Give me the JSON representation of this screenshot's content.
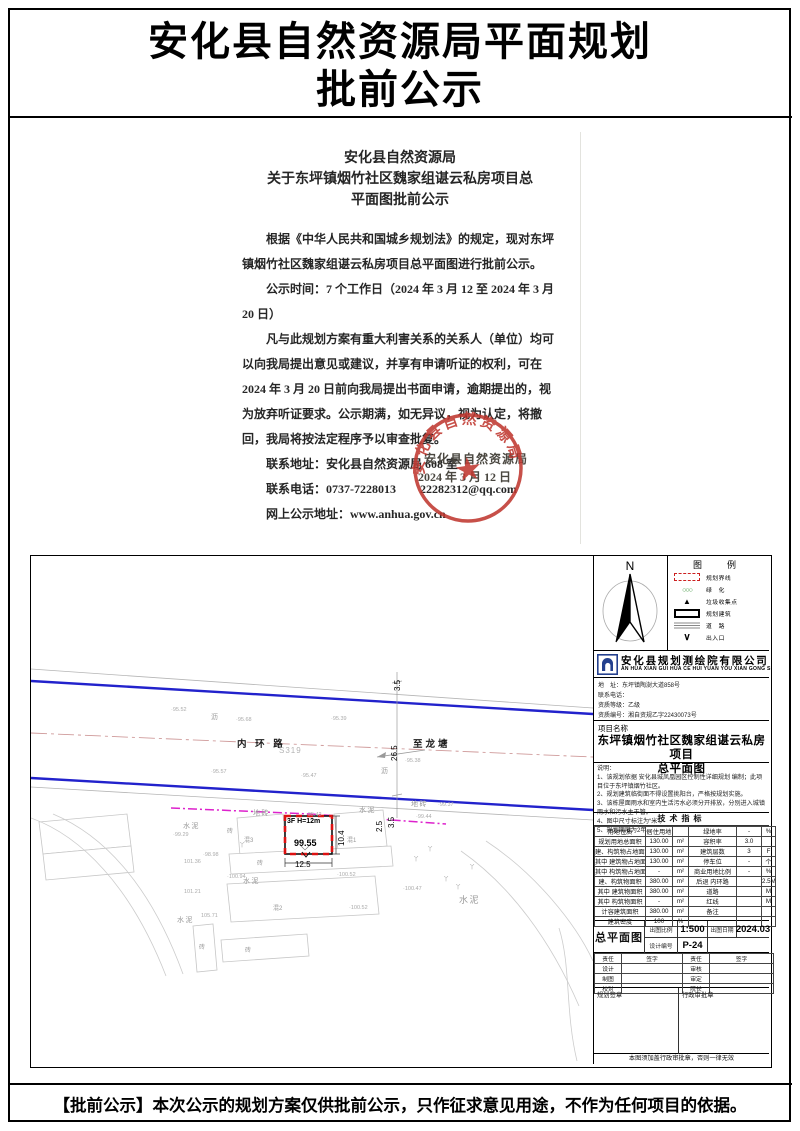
{
  "page": {
    "title_line1": "安化县自然资源局平面规划",
    "title_line2": "批前公示",
    "footer_notice": "【批前公示】本次公示的规划方案仅供批前公示，只作征求意见用途，不作为任何项目的依据。"
  },
  "letter": {
    "heading_lines": [
      "安化县自然资源局",
      "关于东坪镇烟竹社区魏家组谌云私房项目总",
      "平面图批前公示"
    ],
    "paragraphs": [
      "根据《中华人民共和国城乡规划法》的规定，现对东坪镇烟竹社区魏家组谌云私房项目总平面图进行批前公示。",
      "公示时间：7 个工作日（2024 年 3 月 12 至 2024 年 3 月 20 日）",
      "凡与此规划方案有重大利害关系的关系人（单位）均可以向我局提出意见或建议，并享有申请听证的权利，可在 2024 年 3 月 20 日前向我局提出书面申请，逾期提出的，视为放弃听证要求。公示期满，如无异议，视为认定，将撤回，我局将按法定程序予以审查批复。",
      "联系地址：安化县自然资源局 608 室",
      "联系电话：0737-7228013　　22282312@qq.com",
      "网上公示地址：www.anhua.gov.cn"
    ],
    "signature_org": "安化县自然资源局",
    "signature_date": "2024 年 3 月 12 日",
    "stamp_text": "安化县自然资源局"
  },
  "drawing": {
    "compass_label": "N",
    "legend": {
      "title": "图　例",
      "items": [
        {
          "sym": "boundary",
          "label": "规划界线"
        },
        {
          "sym": "green",
          "label": "绿　化"
        },
        {
          "sym": "trash",
          "label": "垃圾收集点"
        },
        {
          "sym": "building",
          "label": "规划建筑"
        },
        {
          "sym": "road",
          "label": "道　路"
        },
        {
          "sym": "entrance",
          "label": "出入口"
        }
      ]
    },
    "company": {
      "name": "安化县规划测绘院有限公司",
      "pinyin": "AN HUA XIAN GUI HUA CE HUI YUAN YOU XIAN GONG SI",
      "address_label": "地　址：东坪镇陶澍大道858号",
      "phone_label": "联系电话：",
      "grade_label": "资质等级：乙级",
      "cert_label": "资质编号：湘自资规乙字22430073号"
    },
    "project": {
      "label": "项目名称",
      "name_line1": "东坪镇烟竹社区魏家组谌云私房项目",
      "name_line2": "总平面图"
    },
    "notes": {
      "title": "说明：",
      "items": [
        "1、该规划依据 安化县城凤凰园区控制性详细规划 编制；此项目位于东坪镇烟竹社区。",
        "2、规划建筑临街面不得设置挑阳台，严格按规划实施。",
        "3、该栋屋面雨水和室内生活污水必须分开排放，分别进入城镇雨水和污水主干管。",
        "4、图中尺寸标注为“米”。",
        "5、规划期限为2年。"
      ]
    },
    "tech": {
      "title": "技术指标",
      "rows": [
        [
          "用地性质",
          "居住用地",
          "",
          "绿地率",
          "-",
          "%"
        ],
        [
          "规划用地总面积",
          "130.00",
          "m²",
          "容积率",
          "3.0",
          ""
        ],
        [
          "建、构筑物占地面积",
          "130.00",
          "m²",
          "建筑层数",
          "3",
          "F"
        ],
        [
          "其中 建筑物占地面积",
          "130.00",
          "m²",
          "停车位",
          "-",
          "个"
        ],
        [
          "其中 构筑物占地面积",
          "-",
          "m²",
          "商业用地比例",
          "-",
          "%"
        ],
        [
          "建、构筑物面积",
          "380.00",
          "m²",
          "后退 内环路",
          "",
          "2.5M"
        ],
        [
          "其中 建筑物面积",
          "380.00",
          "m²",
          "道路",
          "",
          "M"
        ],
        [
          "其中 构筑物面积",
          "-",
          "m²",
          "红线",
          "",
          "M"
        ],
        [
          "计容建筑面积",
          "380.00",
          "m²",
          "备注",
          "",
          ""
        ],
        [
          "建筑密度",
          "100",
          "%",
          "",
          "",
          ""
        ]
      ]
    },
    "sheet": {
      "name": "总平面图",
      "scale_label": "出图比例",
      "scale": "1:500",
      "date_label": "出图日期",
      "date": "2024.03",
      "no_label": "设计编号",
      "no": "P-24"
    },
    "signoff": {
      "header": [
        "责任",
        "签字",
        "责任",
        "签字"
      ],
      "rows": [
        [
          "设计",
          "",
          "审核",
          ""
        ],
        [
          "制图",
          "",
          "审定",
          ""
        ],
        [
          "校对",
          "",
          "院长",
          ""
        ]
      ],
      "left_stamp_label": "规划签章",
      "right_stamp_label": "行政审批章",
      "footnote": "本图须加盖行政审批章，否则一律无效"
    },
    "map": {
      "labels": [
        {
          "t": "沥",
          "x": 180,
          "y": 156,
          "cls": "surf"
        },
        {
          "t": "·95.52",
          "x": 140,
          "y": 151,
          "cls": "elev"
        },
        {
          "t": "·95.68",
          "x": 205,
          "y": 161,
          "cls": "elev"
        },
        {
          "t": "·95.39",
          "x": 300,
          "y": 160,
          "cls": "elev"
        },
        {
          "t": "内 环 路",
          "x": 206,
          "y": 180,
          "cls": "road"
        },
        {
          "t": "S319",
          "x": 248,
          "y": 190,
          "cls": "s319"
        },
        {
          "t": "至龙塘",
          "x": 382,
          "y": 180,
          "cls": "road"
        },
        {
          "t": "·95.57",
          "x": 180,
          "y": 213,
          "cls": "elev"
        },
        {
          "t": "·95.47",
          "x": 270,
          "y": 217,
          "cls": "elev"
        },
        {
          "t": "·95.38",
          "x": 374,
          "y": 202,
          "cls": "elev"
        },
        {
          "t": "沥",
          "x": 350,
          "y": 210,
          "cls": "surf"
        },
        {
          "t": "26.5",
          "x": 359,
          "y": 205,
          "cls": "dim rot"
        },
        {
          "t": "3.5",
          "x": 362,
          "y": 135,
          "cls": "dim rot"
        },
        {
          "t": "地砖",
          "x": 222,
          "y": 252,
          "cls": "surf"
        },
        {
          "t": "·95.42",
          "x": 275,
          "y": 256,
          "cls": "elev"
        },
        {
          "t": "水泥",
          "x": 152,
          "y": 265,
          "cls": "surf"
        },
        {
          "t": "地砖",
          "x": 380,
          "y": 243,
          "cls": "surf"
        },
        {
          "t": "·99.37",
          "x": 407,
          "y": 246,
          "cls": "elev"
        },
        {
          "t": "水泥",
          "x": 328,
          "y": 249,
          "cls": "surf"
        },
        {
          "t": "·99.44",
          "x": 385,
          "y": 258,
          "cls": "elev"
        },
        {
          "t": "2.5",
          "x": 344,
          "y": 276,
          "cls": "dim rot"
        },
        {
          "t": "3.5",
          "x": 356,
          "y": 272,
          "cls": "dim rot"
        },
        {
          "t": "3F H=12m",
          "x": 256,
          "y": 262,
          "cls": "bldg-tag"
        },
        {
          "t": "99.55",
          "x": 263,
          "y": 282,
          "cls": "spot"
        },
        {
          "t": "10.4",
          "x": 306,
          "y": 290,
          "cls": "dim rot"
        },
        {
          "t": "12.5",
          "x": 264,
          "y": 304,
          "cls": "dim"
        },
        {
          "t": "砖",
          "x": 196,
          "y": 270,
          "cls": "bld"
        },
        {
          "t": "混3",
          "x": 213,
          "y": 279,
          "cls": "bld"
        },
        {
          "t": "混1",
          "x": 316,
          "y": 279,
          "cls": "bld"
        },
        {
          "t": "砖",
          "x": 226,
          "y": 302,
          "cls": "bld"
        },
        {
          "t": "·99.29",
          "x": 142,
          "y": 276,
          "cls": "elev"
        },
        {
          "t": "·98.98",
          "x": 172,
          "y": 296,
          "cls": "elev"
        },
        {
          "t": "101.36",
          "x": 153,
          "y": 303,
          "cls": "elev"
        },
        {
          "t": "·100.94",
          "x": 196,
          "y": 318,
          "cls": "elev"
        },
        {
          "t": "水泥",
          "x": 212,
          "y": 320,
          "cls": "surf"
        },
        {
          "t": "101.21",
          "x": 153,
          "y": 333,
          "cls": "elev"
        },
        {
          "t": "·100.52",
          "x": 306,
          "y": 316,
          "cls": "elev"
        },
        {
          "t": "水泥",
          "x": 146,
          "y": 359,
          "cls": "surf"
        },
        {
          "t": "105.71",
          "x": 170,
          "y": 357,
          "cls": "elev"
        },
        {
          "t": "混2",
          "x": 242,
          "y": 347,
          "cls": "bld"
        },
        {
          "t": "·100.47",
          "x": 372,
          "y": 330,
          "cls": "elev"
        },
        {
          "t": "水泥",
          "x": 428,
          "y": 337,
          "cls": "surf big"
        },
        {
          "t": "·100.52",
          "x": 318,
          "y": 349,
          "cls": "elev"
        },
        {
          "t": "砖",
          "x": 168,
          "y": 386,
          "cls": "bld"
        },
        {
          "t": "砖",
          "x": 214,
          "y": 389,
          "cls": "bld"
        },
        {
          "t": "丫",
          "x": 382,
          "y": 298,
          "cls": "tree"
        },
        {
          "t": "丫",
          "x": 396,
          "y": 288,
          "cls": "tree"
        },
        {
          "t": "丫",
          "x": 412,
          "y": 318,
          "cls": "tree"
        },
        {
          "t": "丫",
          "x": 424,
          "y": 326,
          "cls": "tree"
        },
        {
          "t": "丫",
          "x": 438,
          "y": 306,
          "cls": "tree"
        },
        {
          "t": "丫",
          "x": 208,
          "y": 284,
          "cls": "tree"
        }
      ]
    },
    "colors": {
      "road_edge_blue": "#2222cc",
      "boundary_magenta": "#dd22cc",
      "plan_boundary_red": "#dd1111",
      "stamp_red": "#c03830",
      "green": "#2a8a2a"
    }
  }
}
